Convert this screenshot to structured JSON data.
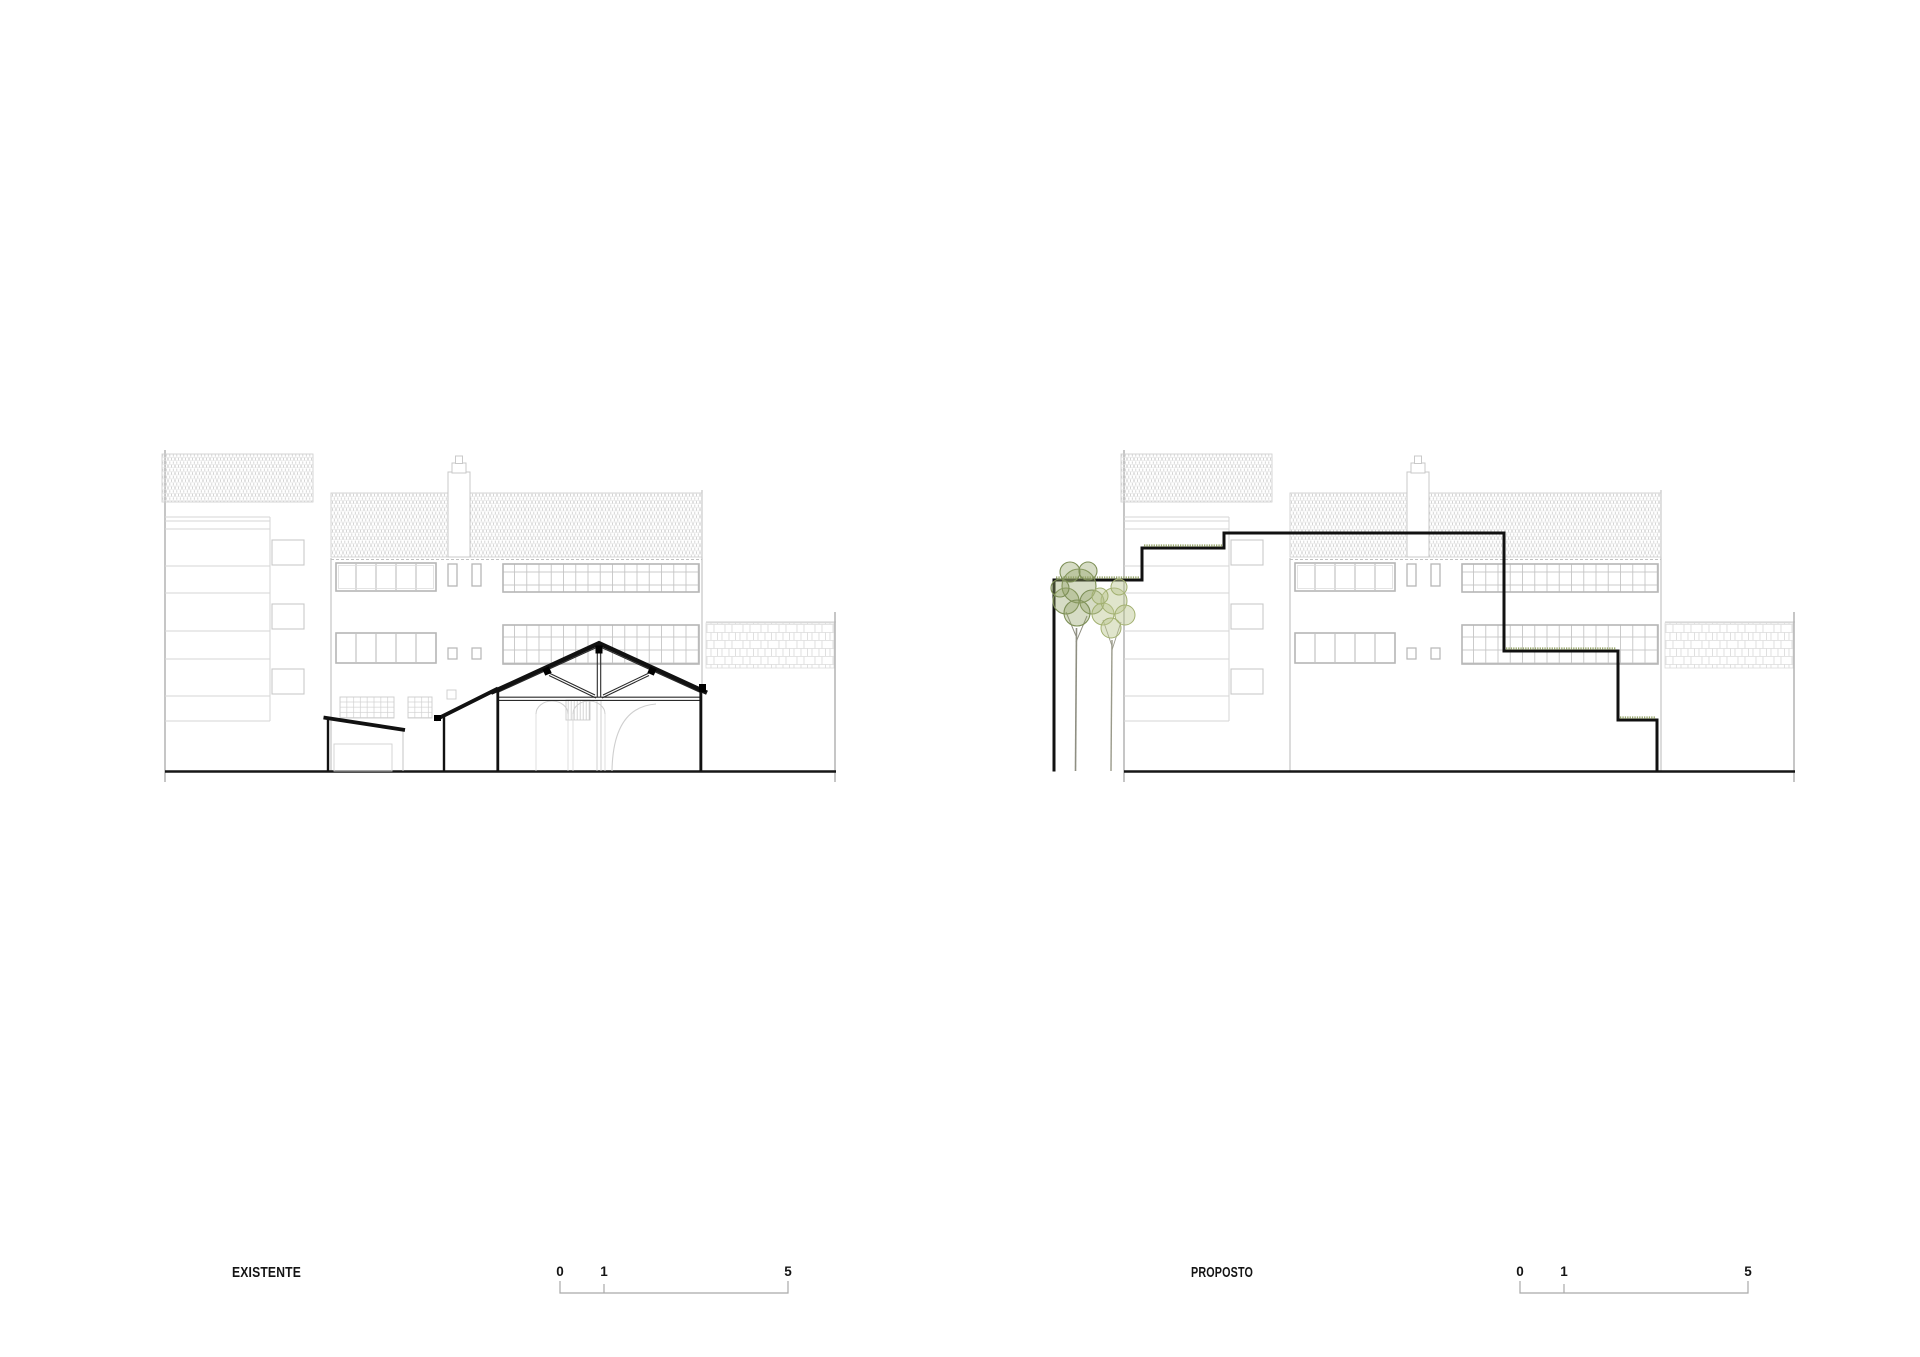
{
  "sheet": {
    "type": "architectural elevation comparison sheet",
    "background": "#ffffff"
  },
  "drawings": [
    {
      "id": "existente",
      "label": "EXISTENTE",
      "kind": "existing rear elevation with sectioned gabled warehouse and timber truss"
    },
    {
      "id": "proposto",
      "label": "PROPOSTO",
      "kind": "proposed stepped volume with green roofs and courtyard trees"
    }
  ],
  "scale_bar": {
    "start": "0",
    "mid": "1",
    "end": "5"
  },
  "colors": {
    "section_line_dark": "#141414",
    "context_line_light": "#c9c9c9",
    "tile_pattern": "#d6d6d6",
    "tree_dark_green": "#7d8f57",
    "tree_light_green": "#a2b070",
    "roof_vegetation": "#9aa86f",
    "scale_bar_line": "#a9a9a9"
  }
}
